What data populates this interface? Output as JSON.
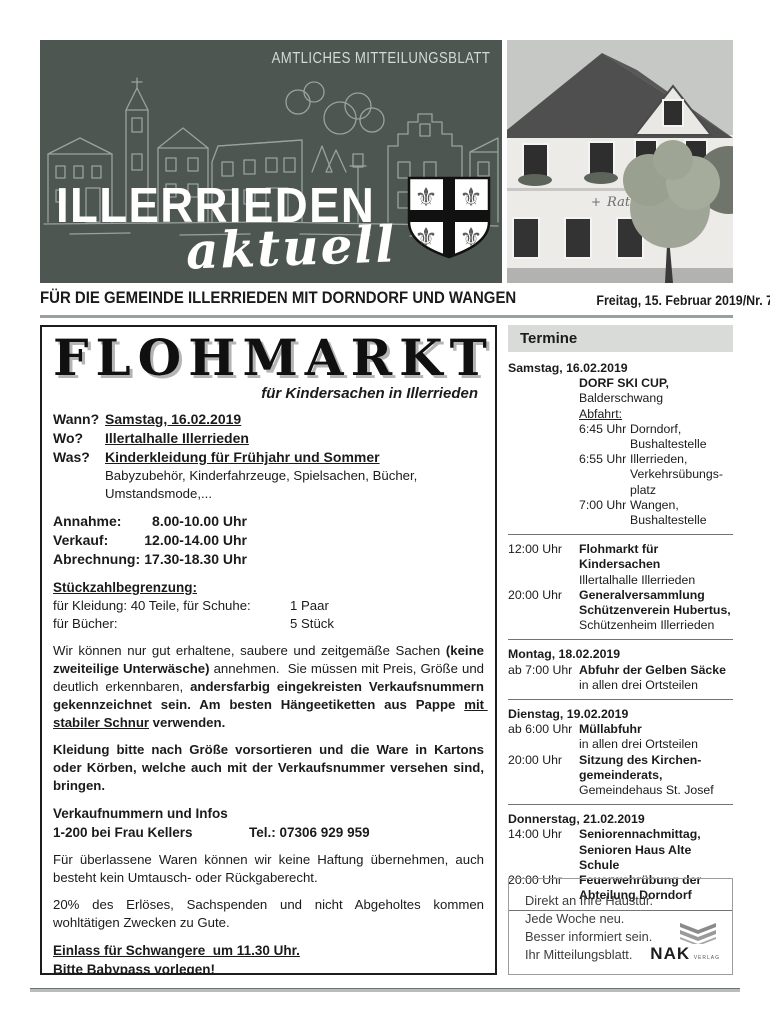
{
  "page": {
    "kicker": "AMTLICHES MITTEILUNGSBLATT",
    "title": "ILLERRIEDEN",
    "title_script": "aktuell",
    "tagline": "FÜR DIE GEMEINDE ILLERRIEDEN MIT DORNDORF UND WANGEN",
    "issue": "Freitag, 15. Februar 2019/Nr. 7",
    "photo_sign": "Rathaus",
    "colors": {
      "banner": "#4d5651",
      "banner_art": "#9aa29f",
      "accent_rule": "#99a09c"
    }
  },
  "flohmarkt": {
    "title": "FLOHMARKT",
    "subtitle": "für Kindersachen in Illerrieden",
    "qa": [
      {
        "label": "Wann?",
        "value": "Samstag, 16.02.2019"
      },
      {
        "label": "Wo?",
        "value": "Illertalhalle Illerrieden"
      },
      {
        "label": "Was?",
        "value": "Kinderkleidung für Frühjahr und Sommer"
      }
    ],
    "was_detail": "Babyzubehör, Kinderfahrzeuge, Spielsachen, Bücher, Umstandsmode,...",
    "schedule": [
      {
        "label": "Annahme:",
        "value": "8.00-10.00 Uhr"
      },
      {
        "label": "Verkauf:",
        "value": "12.00-14.00 Uhr"
      },
      {
        "label": "Abrechnung:",
        "value": "17.30-18.30 Uhr"
      }
    ],
    "limits_heading": "Stückzahlbegrenzung:",
    "limits": [
      {
        "label": "für Kleidung: 40 Teile, für Schuhe:",
        "value": "1 Paar"
      },
      {
        "label": "für Bücher:",
        "value": "5 Stück"
      }
    ],
    "para1": {
      "a": "Wir können nur gut erhaltene, saubere und zeitgemäße Sachen ",
      "b": "(keine zweiteilige Unterwäsche)",
      "c": " annehmen.  Sie müssen mit Preis, Größe und deutlich erkennbaren, ",
      "d": "andersfarbig eingekreisten Verkaufsnummern gekennzeichnet sein. Am besten Hängeetiketten aus Pappe ",
      "e": "mit stabiler Schnur",
      "f": " verwenden."
    },
    "para2": "Kleidung bitte nach Größe vorsortieren und die Ware in Kartons oder Körben, welche auch mit der Verkaufsnummer versehen sind, bringen.",
    "info_heading": "Verkaufnummern und Infos",
    "info_left": "1-200 bei Frau Kellers",
    "info_tel": "Tel.: 07306 929 959",
    "para3": "Für überlassene Waren können wir keine Haftung übernehmen, auch besteht kein Umtausch- oder Rückgaberecht.",
    "para4": "20% des Erlöses, Sachspenden und nicht Abgeholtes kommen wohltätigen Zwecken zu Gute.",
    "notice1": "Einlass für Schwangere  um 11.30 Uhr.",
    "notice2": "Bitte Babypass vorlegen!",
    "para5": "Während des Verkaufs werden Kaffee und Kuchen angeboten.",
    "para6": "Auf Ihren Besuch freut sich das Flohmarktteam!"
  },
  "termine": {
    "heading": "Termine",
    "days": [
      {
        "date": "Samstag, 16.02.2019",
        "special": {
          "title": "DORF SKI CUP,",
          "location": "Balderschwang",
          "label": "Abfahrt:",
          "departures": [
            {
              "time": "6:45 Uhr",
              "lines": [
                "Dorndorf,",
                "Bushaltestelle"
              ]
            },
            {
              "time": "6:55 Uhr",
              "lines": [
                "Illerrieden,",
                "Verkehrsübungs-",
                "platz"
              ]
            },
            {
              "time": "7:00 Uhr",
              "lines": [
                "Wangen,",
                "Bushaltestelle"
              ]
            }
          ]
        },
        "events": [
          {
            "time": "12:00 Uhr",
            "bold_lines": [
              "Flohmarkt für Kindersachen"
            ],
            "normal_lines": [
              "Illertalhalle Illerrieden"
            ]
          },
          {
            "time": "20:00 Uhr",
            "bold_lines": [
              "Generalversammlung",
              "Schützenverein Hubertus,"
            ],
            "normal_lines": [
              "Schützenheim Illerrieden"
            ]
          }
        ]
      },
      {
        "date": "Montag, 18.02.2019",
        "events": [
          {
            "time": "ab 7:00 Uhr",
            "bold_lines": [
              "Abfuhr der Gelben Säcke"
            ],
            "normal_lines": [
              "in allen drei Ortsteilen"
            ]
          }
        ]
      },
      {
        "date": "Dienstag, 19.02.2019",
        "events": [
          {
            "time": "ab 6:00 Uhr",
            "bold_lines": [
              "Müllabfuhr"
            ],
            "normal_lines": [
              "in allen drei Ortsteilen"
            ]
          },
          {
            "time": "20:00 Uhr",
            "bold_lines": [
              "Sitzung des Kirchen-",
              "gemeinderats,"
            ],
            "normal_lines": [
              "Gemeindehaus St. Josef"
            ]
          }
        ]
      },
      {
        "date": "Donnerstag, 21.02.2019",
        "events": [
          {
            "time": "14:00 Uhr",
            "bold_lines": [
              "Seniorennachmittag,",
              "Senioren Haus Alte Schule"
            ],
            "normal_lines": []
          },
          {
            "time": "20:00 Uhr",
            "bold_lines": [
              "Feuerwehrübung der",
              "Abteilung Dorndorf"
            ],
            "normal_lines": []
          }
        ]
      }
    ]
  },
  "promo": {
    "lines": [
      "Direkt an Ihre Haustür.",
      "Jede Woche neu.",
      "Besser informiert sein.",
      "Ihr Mitteilungsblatt."
    ],
    "brand": "NAK",
    "brand_suffix": "VERLAG"
  }
}
